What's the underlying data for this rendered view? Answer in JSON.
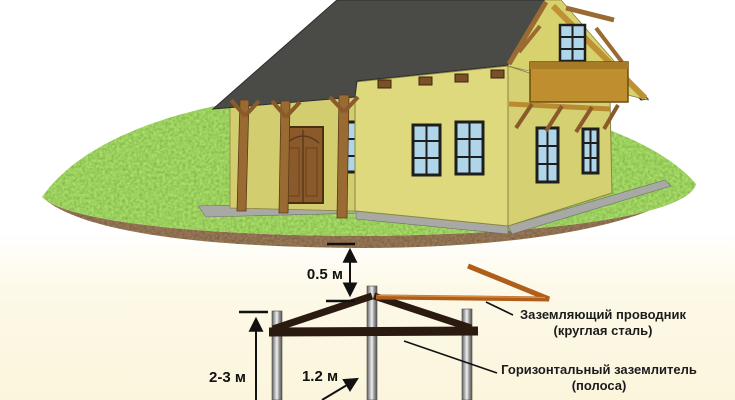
{
  "annotations": {
    "dim_surface_depth": "0.5 м",
    "dim_rod_length": "2-3 м",
    "dim_rod_spacing": "1.2 м",
    "conductor_label_line1": "Заземляющий проводник",
    "conductor_label_line2": "(круглая сталь)",
    "strip_label_line1": "Горизонтальный заземлитель",
    "strip_label_line2": "(полоса)"
  },
  "colors": {
    "sky": "#ffffff",
    "underground_background": "#fbf5dc",
    "grass": "#5ea832",
    "soil": "#3a2413",
    "roof": "#4a4a47",
    "wall": "#ddd97c",
    "wood": "#9a6a33",
    "balcony": "#bf8f2f",
    "window_pane": "#aed6e8",
    "door": "#8b5a2b",
    "walkway": "#a8a8a4",
    "grounding_conductor": "#b05e1c",
    "earth_electrode_strip": "#2b1a10",
    "ground_rod": "#9a9a9a",
    "annotation": "#111111"
  }
}
